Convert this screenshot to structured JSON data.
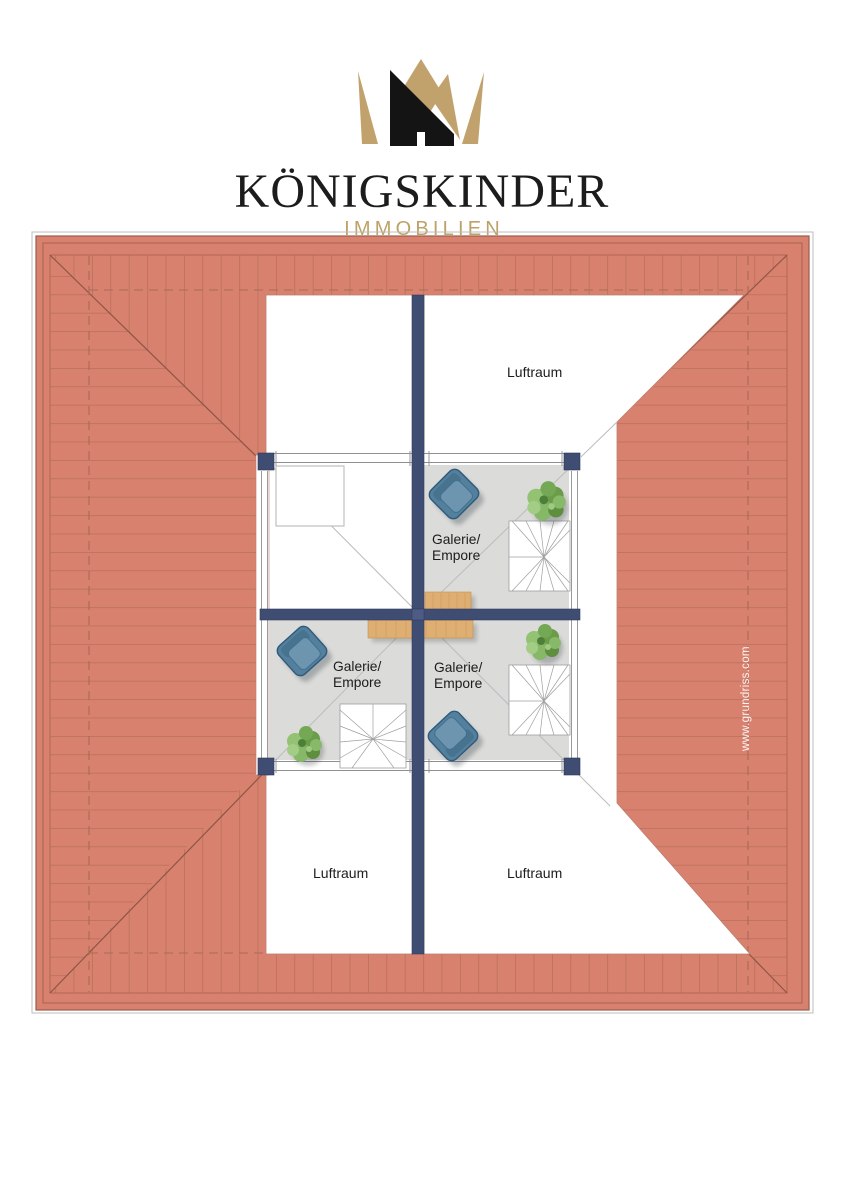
{
  "brand": {
    "name": "KÖNIGSKINDER",
    "division": "IMMOBILIEN"
  },
  "plan": {
    "watermark": "www.grundriss.com",
    "voids": {
      "top_right": "Luftraum",
      "bottom_left": "Luftraum",
      "bottom_right": "Luftraum"
    },
    "rooms": {
      "gallery_top_right": {
        "line1": "Galerie/",
        "line2": "Empore"
      },
      "gallery_bottom_left": {
        "line1": "Galerie/",
        "line2": "Empore"
      },
      "gallery_bottom_right": {
        "line1": "Galerie/",
        "line2": "Empore"
      }
    },
    "colors": {
      "roof": "#d8816e",
      "roof_hatch": "#b56e5b",
      "roof_edge": "#9d5c4a",
      "wall": "#3f4d73",
      "floor": "#dbdbd9",
      "wood": "#dfae72",
      "chair": "#54809e",
      "plant": "#7fae5d",
      "brand_gold": "#bda268",
      "brand_black": "#1c1c1c"
    }
  }
}
